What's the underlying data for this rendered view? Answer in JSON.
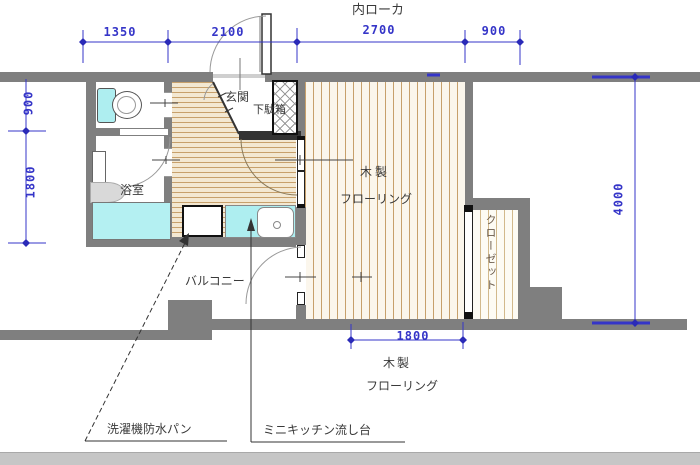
{
  "plan": {
    "title": "内ローカ",
    "rooms": {
      "entrance": "玄関",
      "shoe_box": "下駄箱",
      "bathroom": "浴室",
      "main_room_line1": "木製",
      "main_room_line2": "フローリング",
      "closet": "クローゼット",
      "balcony": "バルコニー",
      "flooring_note_line1": "木製",
      "flooring_note_line2": "フローリング"
    },
    "callouts": {
      "washer_pan": "洗濯機防水パン",
      "mini_kitchen": "ミニキッチン流し台"
    },
    "dimensions": {
      "top": [
        "1350",
        "2100",
        "2700",
        "900"
      ],
      "left": [
        "900",
        "1800"
      ],
      "right": "4000",
      "bottom": "1800"
    },
    "colors": {
      "wall": "#7f7f7f",
      "dimension_blue": "#3535c8",
      "floor_stripe": "#c7a06b",
      "fixture_cyan": "#aeeef0",
      "footer_gray": "#c6c6c6"
    }
  }
}
